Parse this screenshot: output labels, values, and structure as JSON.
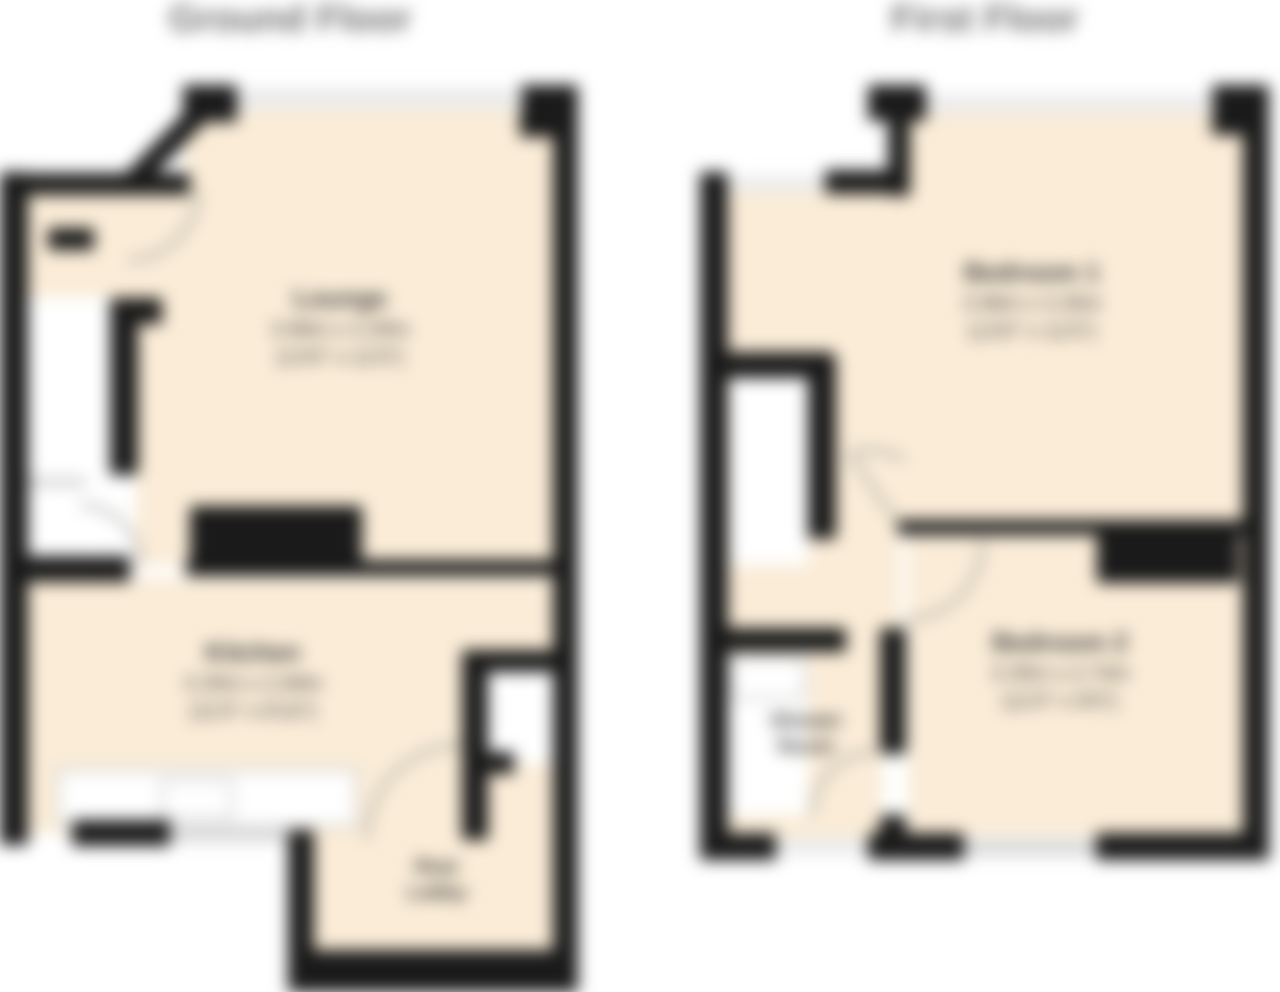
{
  "ground_floor": {
    "title": "Ground Floor",
    "rooms": {
      "lounge": {
        "name": "Lounge",
        "metric": "3.96m x 3.35m",
        "imperial": "(13'0\" x 11'0\")"
      },
      "kitchen": {
        "name": "Kitchen",
        "metric": "3.35m x 2.69m",
        "imperial": "(11'0\" x 8'10\")"
      },
      "rear_lobby": {
        "line1": "Rear",
        "line2": "Lobby"
      }
    }
  },
  "first_floor": {
    "title": "First Floor",
    "rooms": {
      "bedroom1": {
        "name": "Bedroom 1",
        "metric": "3.96m x 3.35m",
        "imperial": "(13'0\" x 11'0\")"
      },
      "bedroom2": {
        "name": "Bedroom 2",
        "metric": "3.35m x 2.74m",
        "imperial": "(11'0\" x 9'0\")"
      },
      "shower_room": {
        "line1": "Shower",
        "line2": "Room"
      }
    }
  },
  "colors": {
    "floor_fill": "#faecd7",
    "wall": "#1a1a1a",
    "window_light": "#ebebeb",
    "window_gray": "#d9d9d9",
    "arc_line": "#8f8f8f",
    "title_text": "#6e6e6e",
    "label_text": "#3a3a3a"
  }
}
